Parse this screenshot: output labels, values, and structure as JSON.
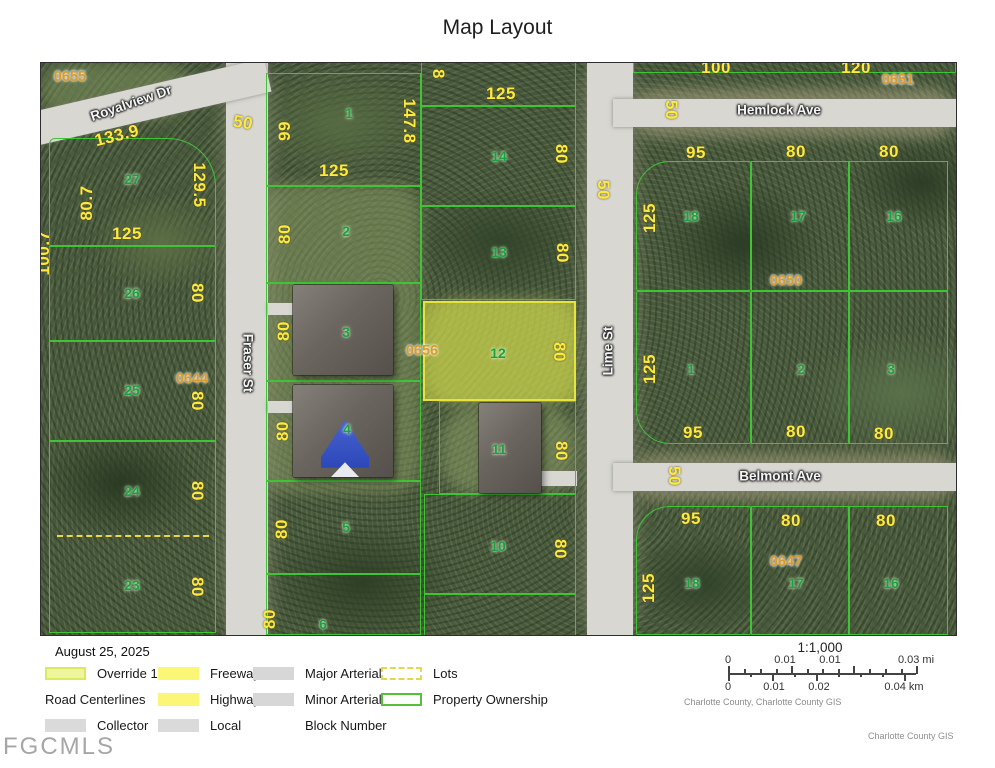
{
  "title": "Map Layout",
  "watermark": "FGCMLS",
  "colors": {
    "parcel_line": "#3ec435",
    "highlight": "#e6e33c",
    "dim_text": "#ffe93c",
    "lot_text": "#18a23c",
    "block_text": "#dc9a28",
    "street_text": "#f5f5f5"
  },
  "map": {
    "labels": [
      {
        "t": "133.9",
        "x": 76,
        "y": 73,
        "c": "dim",
        "r": -14
      },
      {
        "t": "80.7",
        "x": 46,
        "y": 140,
        "c": "dim",
        "r": -90
      },
      {
        "t": "129.5",
        "x": 158,
        "y": 122,
        "c": "dim",
        "r": 90
      },
      {
        "t": "125",
        "x": 86,
        "y": 171,
        "c": "dim"
      },
      {
        "t": "80",
        "x": 156,
        "y": 230,
        "c": "dim",
        "r": 90
      },
      {
        "t": "80",
        "x": 156,
        "y": 338,
        "c": "dim",
        "r": 90
      },
      {
        "t": "80",
        "x": 156,
        "y": 428,
        "c": "dim",
        "r": 90
      },
      {
        "t": "80",
        "x": 156,
        "y": 524,
        "c": "dim",
        "r": 90
      },
      {
        "t": "100.7",
        "x": 3,
        "y": 190,
        "c": "dim",
        "r": -90
      },
      {
        "t": "50",
        "x": 202,
        "y": 60,
        "c": "dim",
        "r": 10
      },
      {
        "t": "99",
        "x": 244,
        "y": 68,
        "c": "dim",
        "r": -90
      },
      {
        "t": "125",
        "x": 293,
        "y": 108,
        "c": "dim"
      },
      {
        "t": "147.8",
        "x": 368,
        "y": 58,
        "c": "dim",
        "r": 90
      },
      {
        "t": "8",
        "x": 397,
        "y": 11,
        "c": "dim",
        "r": 90
      },
      {
        "t": "80",
        "x": 244,
        "y": 171,
        "c": "dim",
        "r": -90
      },
      {
        "t": "80",
        "x": 243,
        "y": 268,
        "c": "dim",
        "r": -90
      },
      {
        "t": "80",
        "x": 242,
        "y": 368,
        "c": "dim",
        "r": -90
      },
      {
        "t": "80",
        "x": 241,
        "y": 466,
        "c": "dim",
        "r": -90
      },
      {
        "t": "80",
        "x": 229,
        "y": 556,
        "c": "dim",
        "r": -90
      },
      {
        "t": "125",
        "x": 460,
        "y": 31,
        "c": "dim"
      },
      {
        "t": "80",
        "x": 520,
        "y": 91,
        "c": "dim",
        "r": 90
      },
      {
        "t": "50",
        "x": 562,
        "y": 127,
        "c": "dim",
        "r": 90
      },
      {
        "t": "80",
        "x": 521,
        "y": 190,
        "c": "dim",
        "r": 90
      },
      {
        "t": "80",
        "x": 518,
        "y": 289,
        "c": "dim",
        "r": 90
      },
      {
        "t": "80",
        "x": 520,
        "y": 388,
        "c": "dim",
        "r": 90
      },
      {
        "t": "80",
        "x": 519,
        "y": 486,
        "c": "dim",
        "r": 90
      },
      {
        "t": "100",
        "x": 675,
        "y": 5,
        "c": "dim"
      },
      {
        "t": "120",
        "x": 815,
        "y": 5,
        "c": "dim"
      },
      {
        "t": "50",
        "x": 630,
        "y": 47,
        "c": "dim",
        "r": 90
      },
      {
        "t": "95",
        "x": 655,
        "y": 90,
        "c": "dim"
      },
      {
        "t": "80",
        "x": 755,
        "y": 89,
        "c": "dim"
      },
      {
        "t": "80",
        "x": 848,
        "y": 89,
        "c": "dim"
      },
      {
        "t": "125",
        "x": 609,
        "y": 155,
        "c": "dim",
        "r": -90
      },
      {
        "t": "125",
        "x": 609,
        "y": 306,
        "c": "dim",
        "r": -90
      },
      {
        "t": "95",
        "x": 652,
        "y": 370,
        "c": "dim"
      },
      {
        "t": "80",
        "x": 755,
        "y": 369,
        "c": "dim"
      },
      {
        "t": "80",
        "x": 843,
        "y": 371,
        "c": "dim"
      },
      {
        "t": "50",
        "x": 633,
        "y": 413,
        "c": "dim",
        "r": 90
      },
      {
        "t": "95",
        "x": 650,
        "y": 456,
        "c": "dim"
      },
      {
        "t": "80",
        "x": 750,
        "y": 458,
        "c": "dim"
      },
      {
        "t": "80",
        "x": 845,
        "y": 458,
        "c": "dim"
      },
      {
        "t": "125",
        "x": 608,
        "y": 525,
        "c": "dim",
        "r": -90
      },
      {
        "t": "27",
        "x": 91,
        "y": 116,
        "c": "lot"
      },
      {
        "t": "26",
        "x": 91,
        "y": 230,
        "c": "lot"
      },
      {
        "t": "25",
        "x": 91,
        "y": 327,
        "c": "lot"
      },
      {
        "t": "24",
        "x": 91,
        "y": 428,
        "c": "lot"
      },
      {
        "t": "23",
        "x": 91,
        "y": 522,
        "c": "lot"
      },
      {
        "t": "1",
        "x": 308,
        "y": 50,
        "c": "lot"
      },
      {
        "t": "2",
        "x": 305,
        "y": 168,
        "c": "lot"
      },
      {
        "t": "3",
        "x": 305,
        "y": 269,
        "c": "lot"
      },
      {
        "t": "4",
        "x": 306,
        "y": 366,
        "c": "lot"
      },
      {
        "t": "5",
        "x": 305,
        "y": 464,
        "c": "lot"
      },
      {
        "t": "6",
        "x": 282,
        "y": 561,
        "c": "lot"
      },
      {
        "t": "14",
        "x": 458,
        "y": 93,
        "c": "lot"
      },
      {
        "t": "13",
        "x": 458,
        "y": 189,
        "c": "lot"
      },
      {
        "t": "12",
        "x": 457,
        "y": 290,
        "c": "lot"
      },
      {
        "t": "11",
        "x": 458,
        "y": 386,
        "c": "lot"
      },
      {
        "t": "10",
        "x": 457,
        "y": 483,
        "c": "lot"
      },
      {
        "t": "18",
        "x": 650,
        "y": 153,
        "c": "lot"
      },
      {
        "t": "17",
        "x": 757,
        "y": 153,
        "c": "lot"
      },
      {
        "t": "16",
        "x": 853,
        "y": 153,
        "c": "lot"
      },
      {
        "t": "1",
        "x": 650,
        "y": 306,
        "c": "lot"
      },
      {
        "t": "2",
        "x": 760,
        "y": 306,
        "c": "lot"
      },
      {
        "t": "3",
        "x": 850,
        "y": 306,
        "c": "lot"
      },
      {
        "t": "18",
        "x": 651,
        "y": 520,
        "c": "lot"
      },
      {
        "t": "17",
        "x": 755,
        "y": 520,
        "c": "lot"
      },
      {
        "t": "16",
        "x": 850,
        "y": 520,
        "c": "lot"
      },
      {
        "t": "0655",
        "x": 29,
        "y": 14,
        "c": "blk"
      },
      {
        "t": "0644",
        "x": 151,
        "y": 316,
        "c": "blk"
      },
      {
        "t": "0656",
        "x": 381,
        "y": 288,
        "c": "blk"
      },
      {
        "t": "0650",
        "x": 745,
        "y": 218,
        "c": "blk"
      },
      {
        "t": "0651",
        "x": 857,
        "y": 17,
        "c": "blk"
      },
      {
        "t": "0647",
        "x": 745,
        "y": 499,
        "c": "blk"
      },
      {
        "t": "Royalview Dr",
        "x": 90,
        "y": 40,
        "c": "st",
        "r": -19
      },
      {
        "t": "Fraser St",
        "x": 207,
        "y": 300,
        "c": "st",
        "r": 90
      },
      {
        "t": "Lime St",
        "x": 567,
        "y": 288,
        "c": "st",
        "r": -90
      },
      {
        "t": "Hemlock Ave",
        "x": 738,
        "y": 47,
        "c": "st"
      },
      {
        "t": "Belmont Ave",
        "x": 739,
        "y": 413,
        "c": "st"
      }
    ]
  },
  "legend": {
    "date": "August 25, 2025",
    "items": [
      {
        "swatch": "override",
        "label": "Override 1"
      },
      {
        "swatch": "freeway",
        "label": "Freeway"
      },
      {
        "swatch": "arterial",
        "label": "Major Arterial"
      },
      {
        "swatch": "lots",
        "label": "Lots"
      },
      {
        "swatch": "flush",
        "label": "Road Centerlines"
      },
      {
        "swatch": "highway",
        "label": "Highway"
      },
      {
        "swatch": "arterial",
        "label": "Minor Arterial"
      },
      {
        "swatch": "ownership",
        "label": "Property Ownership"
      },
      {
        "swatch": "collector",
        "label": "Collector"
      },
      {
        "swatch": "local",
        "label": "Local"
      },
      {
        "swatch": "spacer",
        "label": "Block Number"
      },
      {
        "swatch": "empty",
        "label": ""
      }
    ]
  },
  "scale": {
    "ratio": "1:1,000",
    "mi_labels": [
      "0",
      "0.01",
      "0.01",
      "0.03 mi"
    ],
    "km_labels": [
      "0",
      "0.01",
      "0.02",
      "0.04 km"
    ],
    "attribution": "Charlotte County, Charlotte County GIS",
    "credit": "Charlotte County GIS"
  }
}
